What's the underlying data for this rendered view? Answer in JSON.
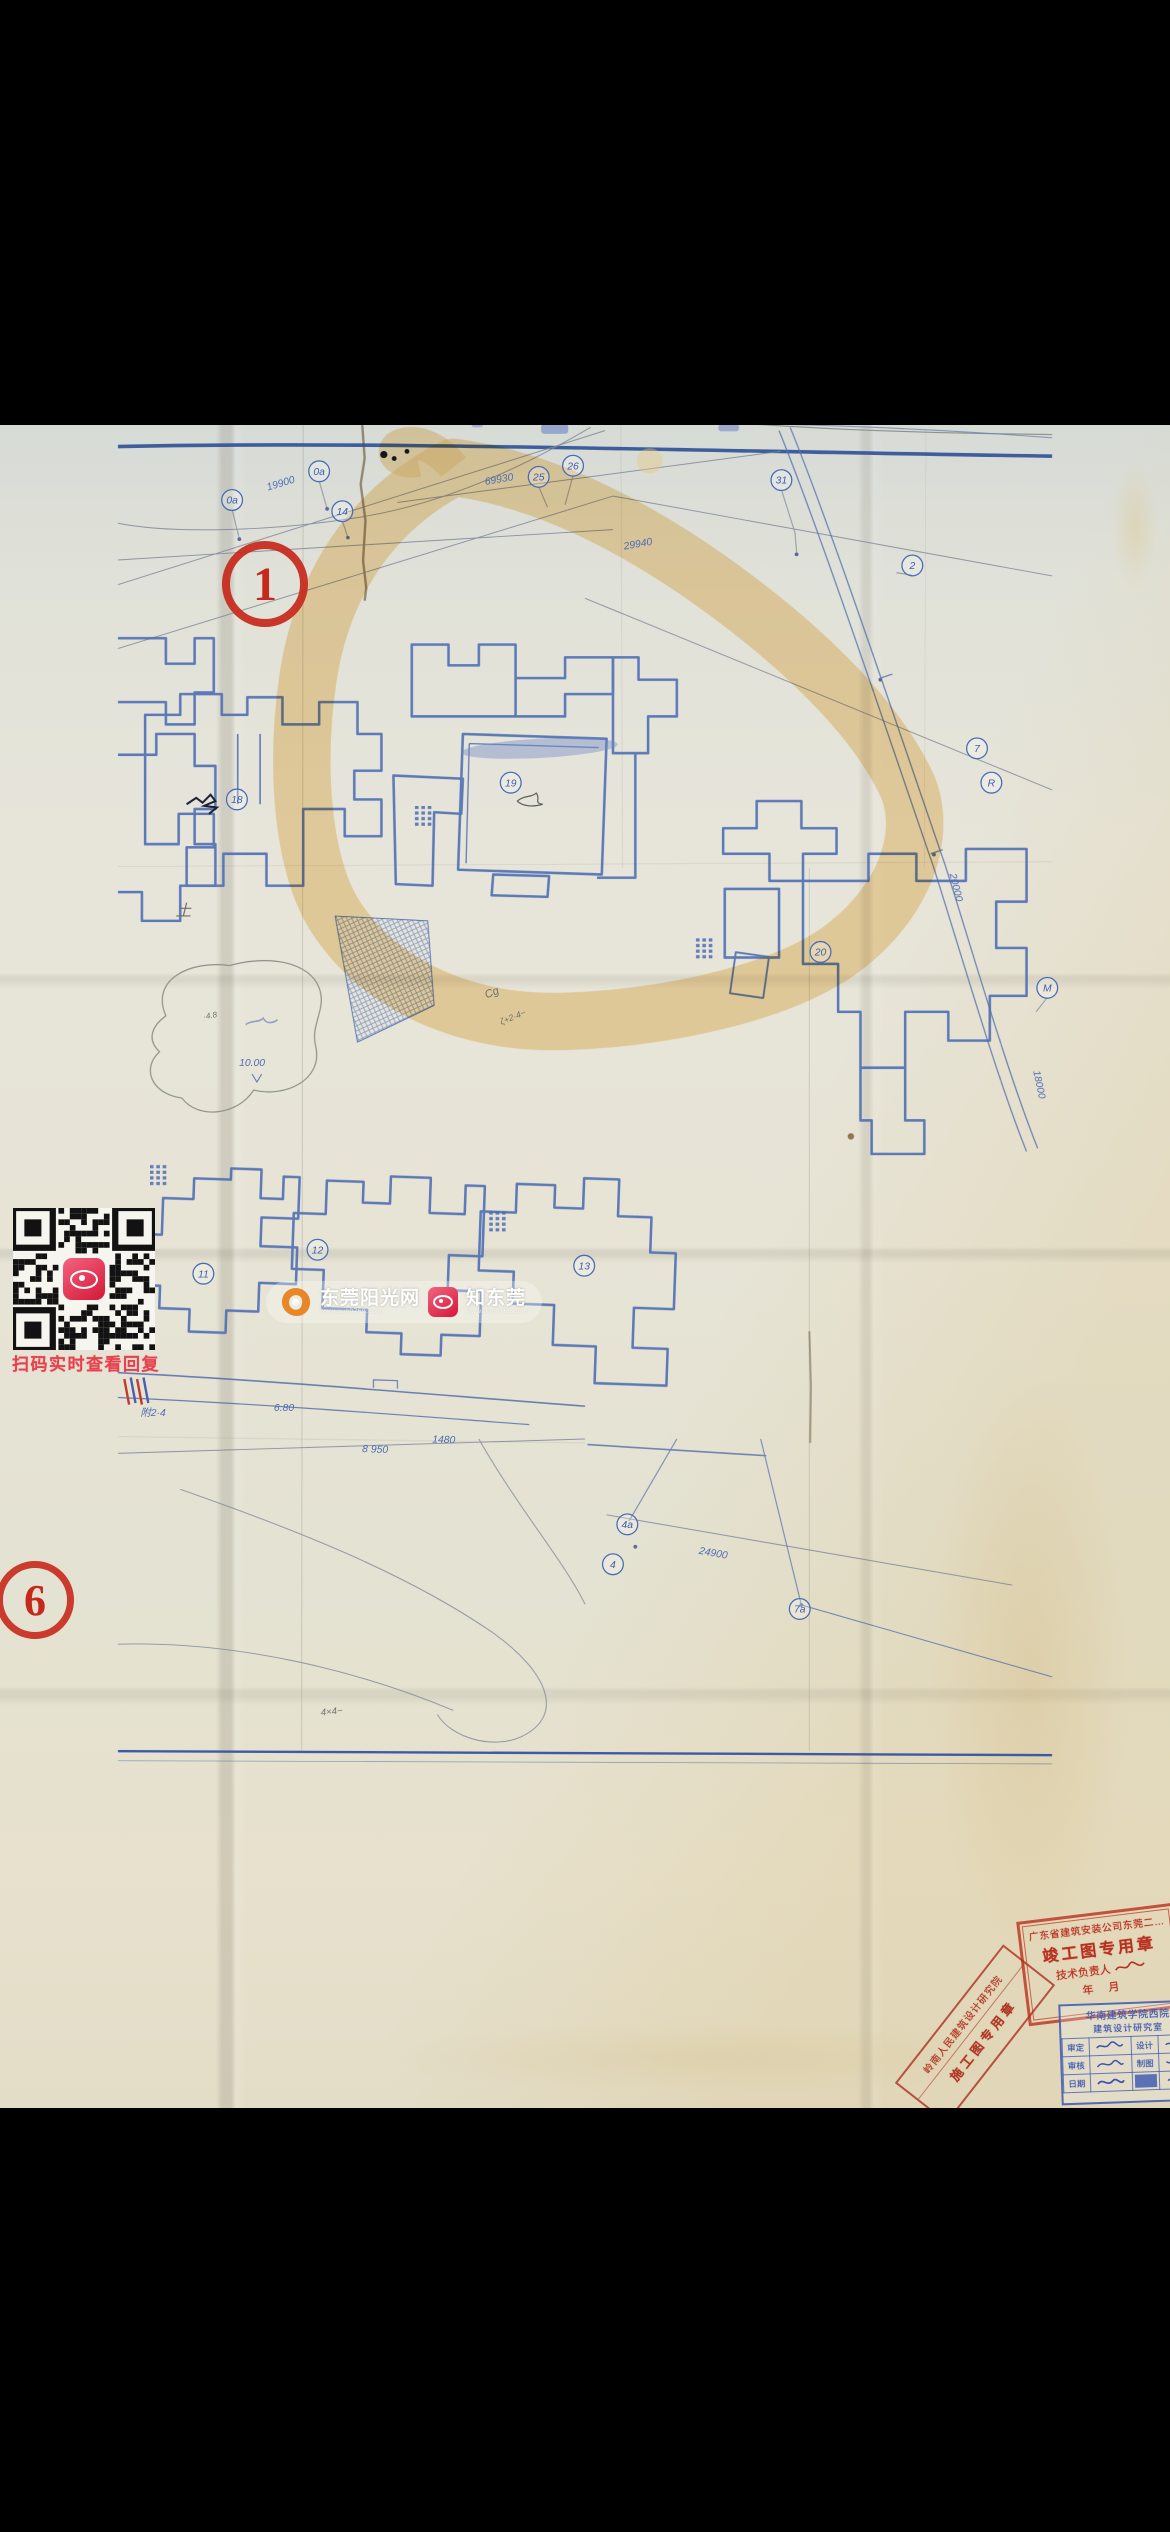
{
  "annotations": {
    "circle1": {
      "label": "1"
    },
    "circle6": {
      "label": "6"
    },
    "qr_caption": "扫码实时查看回复"
  },
  "watermark": {
    "brand1": "东莞阳光网",
    "brand1_sub": "www.sun0769.com",
    "brand2": "知东莞",
    "brand2_sub": "www.sun0769.com",
    "accent_orange": "#e8821e",
    "accent_red": "#d51738"
  },
  "plan": {
    "bubbles": [
      {
        "t": "0a",
        "x": 143,
        "y": 519
      },
      {
        "t": "0a",
        "x": 252,
        "y": 483
      },
      {
        "t": "14",
        "x": 281,
        "y": 533
      },
      {
        "t": "25",
        "x": 527,
        "y": 490
      },
      {
        "t": "26",
        "x": 570,
        "y": 476
      },
      {
        "t": "31",
        "x": 831,
        "y": 494
      },
      {
        "t": "2",
        "x": 995,
        "y": 601
      },
      {
        "t": "7",
        "x": 1076,
        "y": 830
      },
      {
        "t": "R",
        "x": 1094,
        "y": 873
      },
      {
        "t": "M",
        "x": 1164,
        "y": 1130
      },
      {
        "t": "18",
        "x": 149,
        "y": 894
      },
      {
        "t": "19",
        "x": 492,
        "y": 873
      },
      {
        "t": "20",
        "x": 880,
        "y": 1085
      },
      {
        "t": "11",
        "x": 107,
        "y": 1488
      },
      {
        "t": "12",
        "x": 250,
        "y": 1458
      },
      {
        "t": "13",
        "x": 584,
        "y": 1478
      },
      {
        "t": "4a",
        "x": 638,
        "y": 1802
      },
      {
        "t": "4",
        "x": 620,
        "y": 1852
      },
      {
        "t": "7a",
        "x": 854,
        "y": 1908
      }
    ],
    "dims": [
      {
        "t": "19900",
        "x": 205,
        "y": 502,
        "r": -17
      },
      {
        "t": "69930",
        "x": 478,
        "y": 497,
        "r": -10
      },
      {
        "t": "29940",
        "x": 652,
        "y": 578,
        "r": -10
      },
      {
        "t": "20000",
        "x": 1046,
        "y": 1005,
        "r": 76
      },
      {
        "t": "18000",
        "x": 1150,
        "y": 1252,
        "r": 78
      },
      {
        "t": "24900",
        "x": 745,
        "y": 1842,
        "r": 10
      },
      {
        "t": "8 950",
        "x": 322,
        "y": 1712,
        "r": 2
      },
      {
        "t": "1480",
        "x": 408,
        "y": 1700,
        "r": 2
      },
      {
        "t": "10.00",
        "x": 168,
        "y": 1228,
        "r": 0
      },
      {
        "t": "6.80",
        "x": 208,
        "y": 1660,
        "r": 0
      },
      {
        "t": "附2·4",
        "x": 44,
        "y": 1666,
        "r": 0
      }
    ],
    "pencil": [
      {
        "t": "土",
        "x": 82,
        "y": 1040,
        "r": 0,
        "s": 20
      },
      {
        "t": "Cg",
        "x": 470,
        "y": 1140,
        "r": -22,
        "s": 14
      },
      {
        "t": "ζ+2·4~",
        "x": 496,
        "y": 1170,
        "r": -22,
        "s": 11
      },
      {
        "t": "4×4~",
        "x": 268,
        "y": 2040,
        "r": -6,
        "s": 12
      },
      {
        "t": "·4.8",
        "x": 116,
        "y": 1168,
        "r": -10,
        "s": 10
      }
    ],
    "line_color": "#4a6cb3",
    "road_color": "#2e4f96",
    "highlight_color": "#f0c474"
  },
  "stamps": {
    "builder": {
      "line1": "广东省建筑安装公司东莞二…",
      "line2": "竣工图专用章",
      "line3": "技术负责人",
      "line4": "年    月"
    },
    "design": {
      "line1": "岭南人民建筑设计研究院",
      "line2": "施工图专用章"
    },
    "review": {
      "header1": "华南建筑学院西院",
      "header2": "建筑设计研究室",
      "row1c1": "审定",
      "row1c3": "设计",
      "row2c1": "审核",
      "row2c3": "制图",
      "row3c1": "日期"
    }
  }
}
